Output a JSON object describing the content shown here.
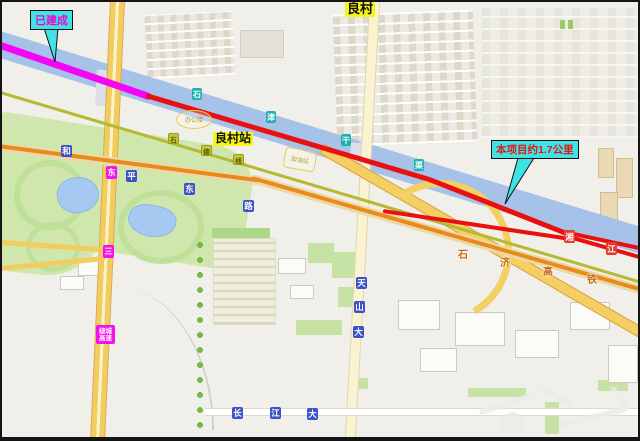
{
  "callouts": {
    "built": "已建成",
    "project": "本项目约1.7公里"
  },
  "labels": {
    "village": "良村",
    "station": "良村站"
  },
  "canal_badges": [
    "石",
    "津",
    "干",
    "渠"
  ],
  "railway_badges": [
    "石",
    "德",
    "线"
  ],
  "hsr_chars": [
    "石",
    "济",
    "高",
    "铁"
  ],
  "heping_badges": [
    "和",
    "平",
    "东",
    "路"
  ],
  "ring_badges": [
    "东",
    "三"
  ],
  "expressway_badge": "绕城高速",
  "tianshan_badges": [
    "天",
    "山",
    "大"
  ],
  "changjiang_badges": [
    "长",
    "江",
    "大"
  ],
  "red_shields": [
    "湘",
    "江"
  ],
  "pois": {
    "office": "办公楼",
    "gas": "加油站"
  },
  "colors": {
    "built_line": "#f505f5",
    "project_line": "#e81010",
    "callout_bg": "#3fe3e3",
    "highlight": "#f6f618",
    "canal": "#a7c2e8",
    "railway": "#b5ba30",
    "hsr_line": "#e88b1c"
  }
}
